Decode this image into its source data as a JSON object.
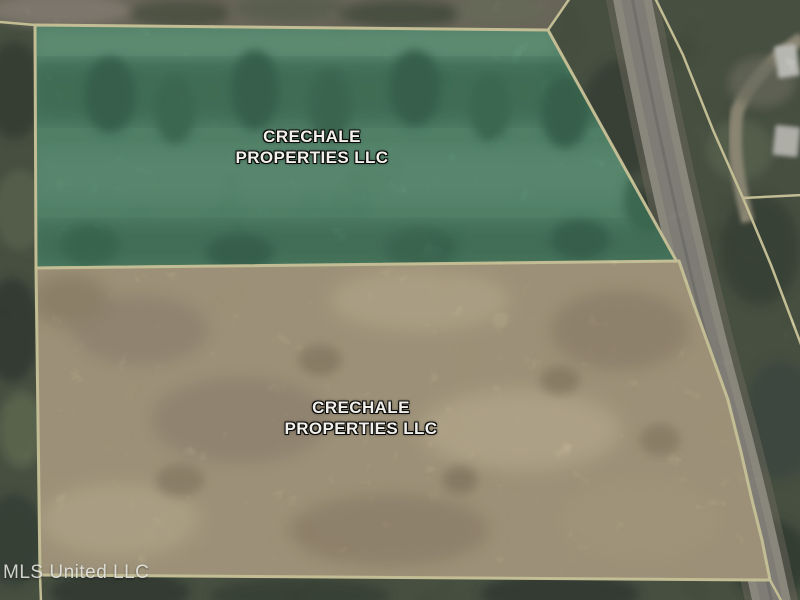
{
  "map": {
    "kind": "satellite-parcel-aerial",
    "watermark": "MLS United LLC",
    "boundary_color": "#e4dda8",
    "parcels": [
      {
        "id": "north-parcel",
        "owner_line1": "CRECHALE",
        "owner_line2": "PROPERTIES LLC",
        "overlay_color": "#4f8c6d"
      },
      {
        "id": "south-parcel",
        "owner_line1": "CRECHALE",
        "owner_line2": "PROPERTIES LLC",
        "overlay_color": "#b3a484"
      }
    ],
    "road_color": "#94918a",
    "forest_color": "#434e3c"
  }
}
